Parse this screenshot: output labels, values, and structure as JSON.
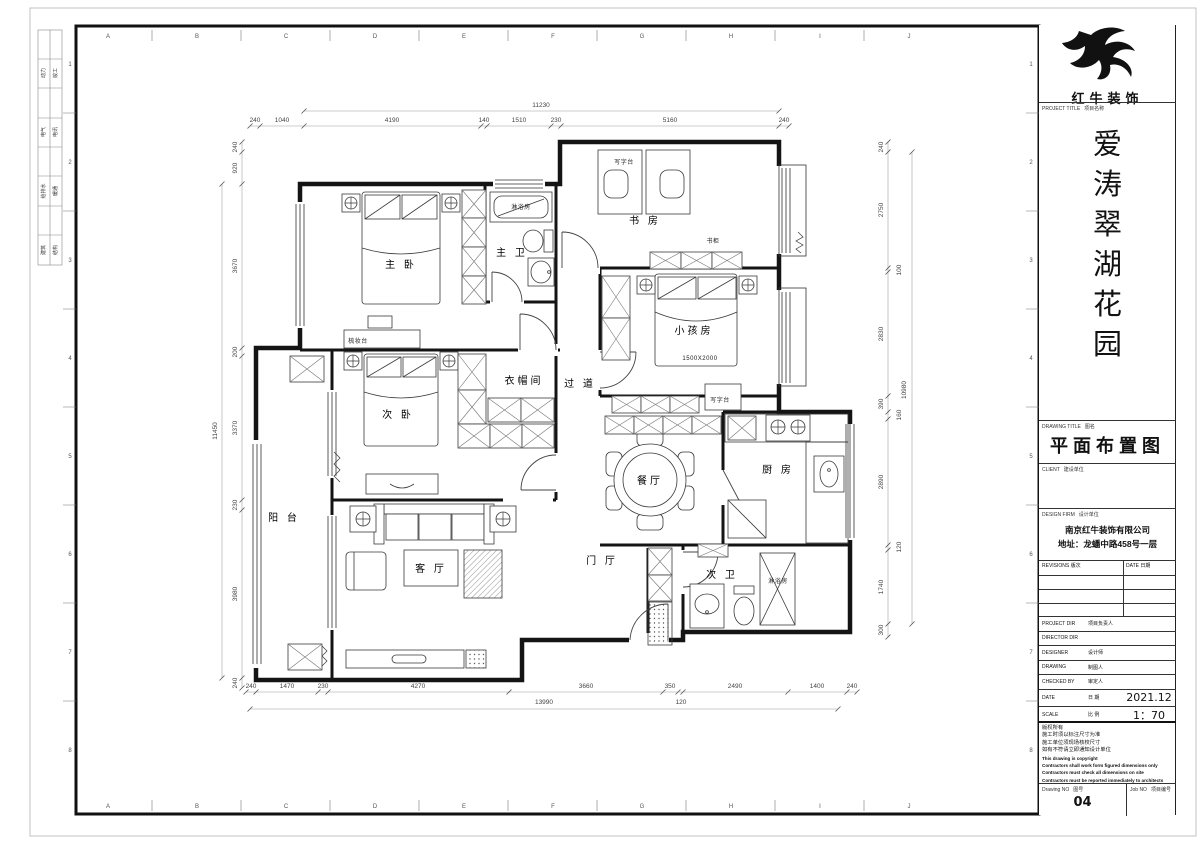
{
  "sheet": {
    "grid_letters": [
      "A",
      "B",
      "C",
      "D",
      "E",
      "F",
      "G",
      "H",
      "I",
      "J"
    ],
    "grid_numbers": [
      "1",
      "2",
      "3",
      "4",
      "5",
      "6",
      "7",
      "8"
    ],
    "discipline_pairs": [
      [
        "动力",
        "竣工"
      ],
      [
        "电气",
        "电讯"
      ],
      [
        "给排水",
        "暖通"
      ],
      [
        "建筑",
        "结构"
      ]
    ],
    "line_color": "#141414",
    "dim_color": "#444444"
  },
  "title_block": {
    "brand": "红牛装饰",
    "project_title_label": "PROJECT TITLE",
    "project_title_label_cn": "项目名称",
    "project_name_chars": [
      "爱",
      "涛",
      "翠",
      "湖",
      "花",
      "园"
    ],
    "drawing_title_label": "DRAWING TITLE",
    "drawing_title_label_cn": "图名",
    "drawing_title": "平面布置图",
    "client_label": "CLIENT",
    "client_label_cn": "建设单位",
    "design_firm_label": "DESIGN FIRM",
    "design_firm_label_cn": "设计单位",
    "design_firm_name": "南京红牛装饰有限公司",
    "design_firm_address": "地址：龙蟠中路458号一层",
    "revisions_label": "REVISIONS",
    "revisions_label_cn": "版次",
    "date_col_label": "DATE",
    "date_col_label_cn": "日期",
    "rows": [
      {
        "en": "PROJECT DIR",
        "cn": "项目负责人",
        "val": ""
      },
      {
        "en": "DIRECTOR DIR",
        "cn": "",
        "val": ""
      },
      {
        "en": "DESIGNER",
        "cn": "设计师",
        "val": ""
      },
      {
        "en": "DRAWING",
        "cn": "制图人",
        "val": ""
      },
      {
        "en": "CHECKED BY",
        "cn": "审定人",
        "val": ""
      },
      {
        "en": "DATE",
        "cn": "日 期",
        "val": "2021.12"
      },
      {
        "en": "SCALE",
        "cn": "比 例",
        "val": "1：70"
      }
    ],
    "copyright_lines": [
      {
        "t": "版权所有",
        "en": false
      },
      {
        "t": "施工时须以标注尺寸为准",
        "en": false
      },
      {
        "t": "施工单位须现场核校尺寸",
        "en": false
      },
      {
        "t": "如有不符请立即通知设计单位",
        "en": false
      },
      {
        "t": "This drawing is copyright",
        "en": true
      },
      {
        "t": "Contractors shall work form figured dimensions only",
        "en": true
      },
      {
        "t": "Contractors must check all dimensions on site",
        "en": true
      },
      {
        "t": "Contractors must be reported immediately to architects",
        "en": true
      }
    ],
    "drawing_no_label": "Drawing NO",
    "drawing_no_label_cn": "图号",
    "drawing_no": "04",
    "job_no_label": "Job NO",
    "job_no_label_cn": "项目编号"
  },
  "plan": {
    "room_labels": [
      {
        "t": "主 卧",
        "x": 401,
        "y": 268
      },
      {
        "t": "主 卫",
        "x": 512,
        "y": 256
      },
      {
        "t": "书 房",
        "x": 645,
        "y": 224
      },
      {
        "t": "小孩房",
        "x": 694,
        "y": 334
      },
      {
        "t": "衣帽间",
        "x": 524,
        "y": 384
      },
      {
        "t": "过 道",
        "x": 580,
        "y": 387
      },
      {
        "t": "次 卧",
        "x": 398,
        "y": 418
      },
      {
        "t": "餐厅",
        "x": 650,
        "y": 484
      },
      {
        "t": "厨 房",
        "x": 778,
        "y": 473
      },
      {
        "t": "阳 台",
        "x": 284,
        "y": 521
      },
      {
        "t": "客 厅",
        "x": 431,
        "y": 572
      },
      {
        "t": "门 厅",
        "x": 602,
        "y": 564
      },
      {
        "t": "次 卫",
        "x": 722,
        "y": 578
      }
    ],
    "small_labels": [
      {
        "t": "淋浴房",
        "x": 521,
        "y": 209
      },
      {
        "t": "写字台",
        "x": 624,
        "y": 164
      },
      {
        "t": "书柜",
        "x": 713,
        "y": 243
      },
      {
        "t": "1500X2000",
        "x": 700,
        "y": 360
      },
      {
        "t": "写字台",
        "x": 720,
        "y": 402
      },
      {
        "t": "梳妆台",
        "x": 358,
        "y": 343
      },
      {
        "t": "淋浴房",
        "x": 778,
        "y": 583
      }
    ],
    "dims": [
      {
        "t": "11230",
        "x": 541,
        "y": 107,
        "r": 0
      },
      {
        "t": "240",
        "x": 255,
        "y": 122,
        "r": 0
      },
      {
        "t": "1040",
        "x": 282,
        "y": 122,
        "r": 0
      },
      {
        "t": "4190",
        "x": 392,
        "y": 122,
        "r": 0
      },
      {
        "t": "140",
        "x": 484,
        "y": 122,
        "r": 0
      },
      {
        "t": "1510",
        "x": 519,
        "y": 122,
        "r": 0
      },
      {
        "t": "230",
        "x": 556,
        "y": 122,
        "r": 0
      },
      {
        "t": "5160",
        "x": 670,
        "y": 122,
        "r": 0
      },
      {
        "t": "240",
        "x": 784,
        "y": 122,
        "r": 0
      },
      {
        "t": "11450",
        "x": 217,
        "y": 431,
        "r": 1
      },
      {
        "t": "240",
        "x": 237,
        "y": 147,
        "r": 1
      },
      {
        "t": "920",
        "x": 237,
        "y": 168,
        "r": 1
      },
      {
        "t": "3670",
        "x": 237,
        "y": 266,
        "r": 1
      },
      {
        "t": "200",
        "x": 237,
        "y": 352,
        "r": 1
      },
      {
        "t": "3370",
        "x": 237,
        "y": 428,
        "r": 1
      },
      {
        "t": "230",
        "x": 237,
        "y": 505,
        "r": 1
      },
      {
        "t": "3980",
        "x": 237,
        "y": 594,
        "r": 1
      },
      {
        "t": "240",
        "x": 237,
        "y": 683,
        "r": 1
      },
      {
        "t": "240",
        "x": 883,
        "y": 147,
        "r": 1
      },
      {
        "t": "2750",
        "x": 883,
        "y": 210,
        "r": 1
      },
      {
        "t": "100",
        "x": 901,
        "y": 270,
        "r": 1
      },
      {
        "t": "2830",
        "x": 883,
        "y": 334,
        "r": 1
      },
      {
        "t": "390",
        "x": 883,
        "y": 404,
        "r": 1
      },
      {
        "t": "160",
        "x": 901,
        "y": 415,
        "r": 1
      },
      {
        "t": "2890",
        "x": 883,
        "y": 482,
        "r": 1
      },
      {
        "t": "120",
        "x": 901,
        "y": 547,
        "r": 1
      },
      {
        "t": "1740",
        "x": 883,
        "y": 587,
        "r": 1
      },
      {
        "t": "300",
        "x": 883,
        "y": 630,
        "r": 1
      },
      {
        "t": "10980",
        "x": 906,
        "y": 390,
        "r": 1
      },
      {
        "t": "240",
        "x": 251,
        "y": 688,
        "r": 0
      },
      {
        "t": "1470",
        "x": 287,
        "y": 688,
        "r": 0
      },
      {
        "t": "230",
        "x": 323,
        "y": 688,
        "r": 0
      },
      {
        "t": "4270",
        "x": 418,
        "y": 688,
        "r": 0
      },
      {
        "t": "3660",
        "x": 586,
        "y": 688,
        "r": 0
      },
      {
        "t": "350",
        "x": 670,
        "y": 688,
        "r": 0
      },
      {
        "t": "2490",
        "x": 735,
        "y": 688,
        "r": 0
      },
      {
        "t": "1400",
        "x": 817,
        "y": 688,
        "r": 0
      },
      {
        "t": "240",
        "x": 852,
        "y": 688,
        "r": 0
      },
      {
        "t": "13990",
        "x": 544,
        "y": 704,
        "r": 0
      },
      {
        "t": "120",
        "x": 681,
        "y": 704,
        "r": 0
      }
    ]
  }
}
